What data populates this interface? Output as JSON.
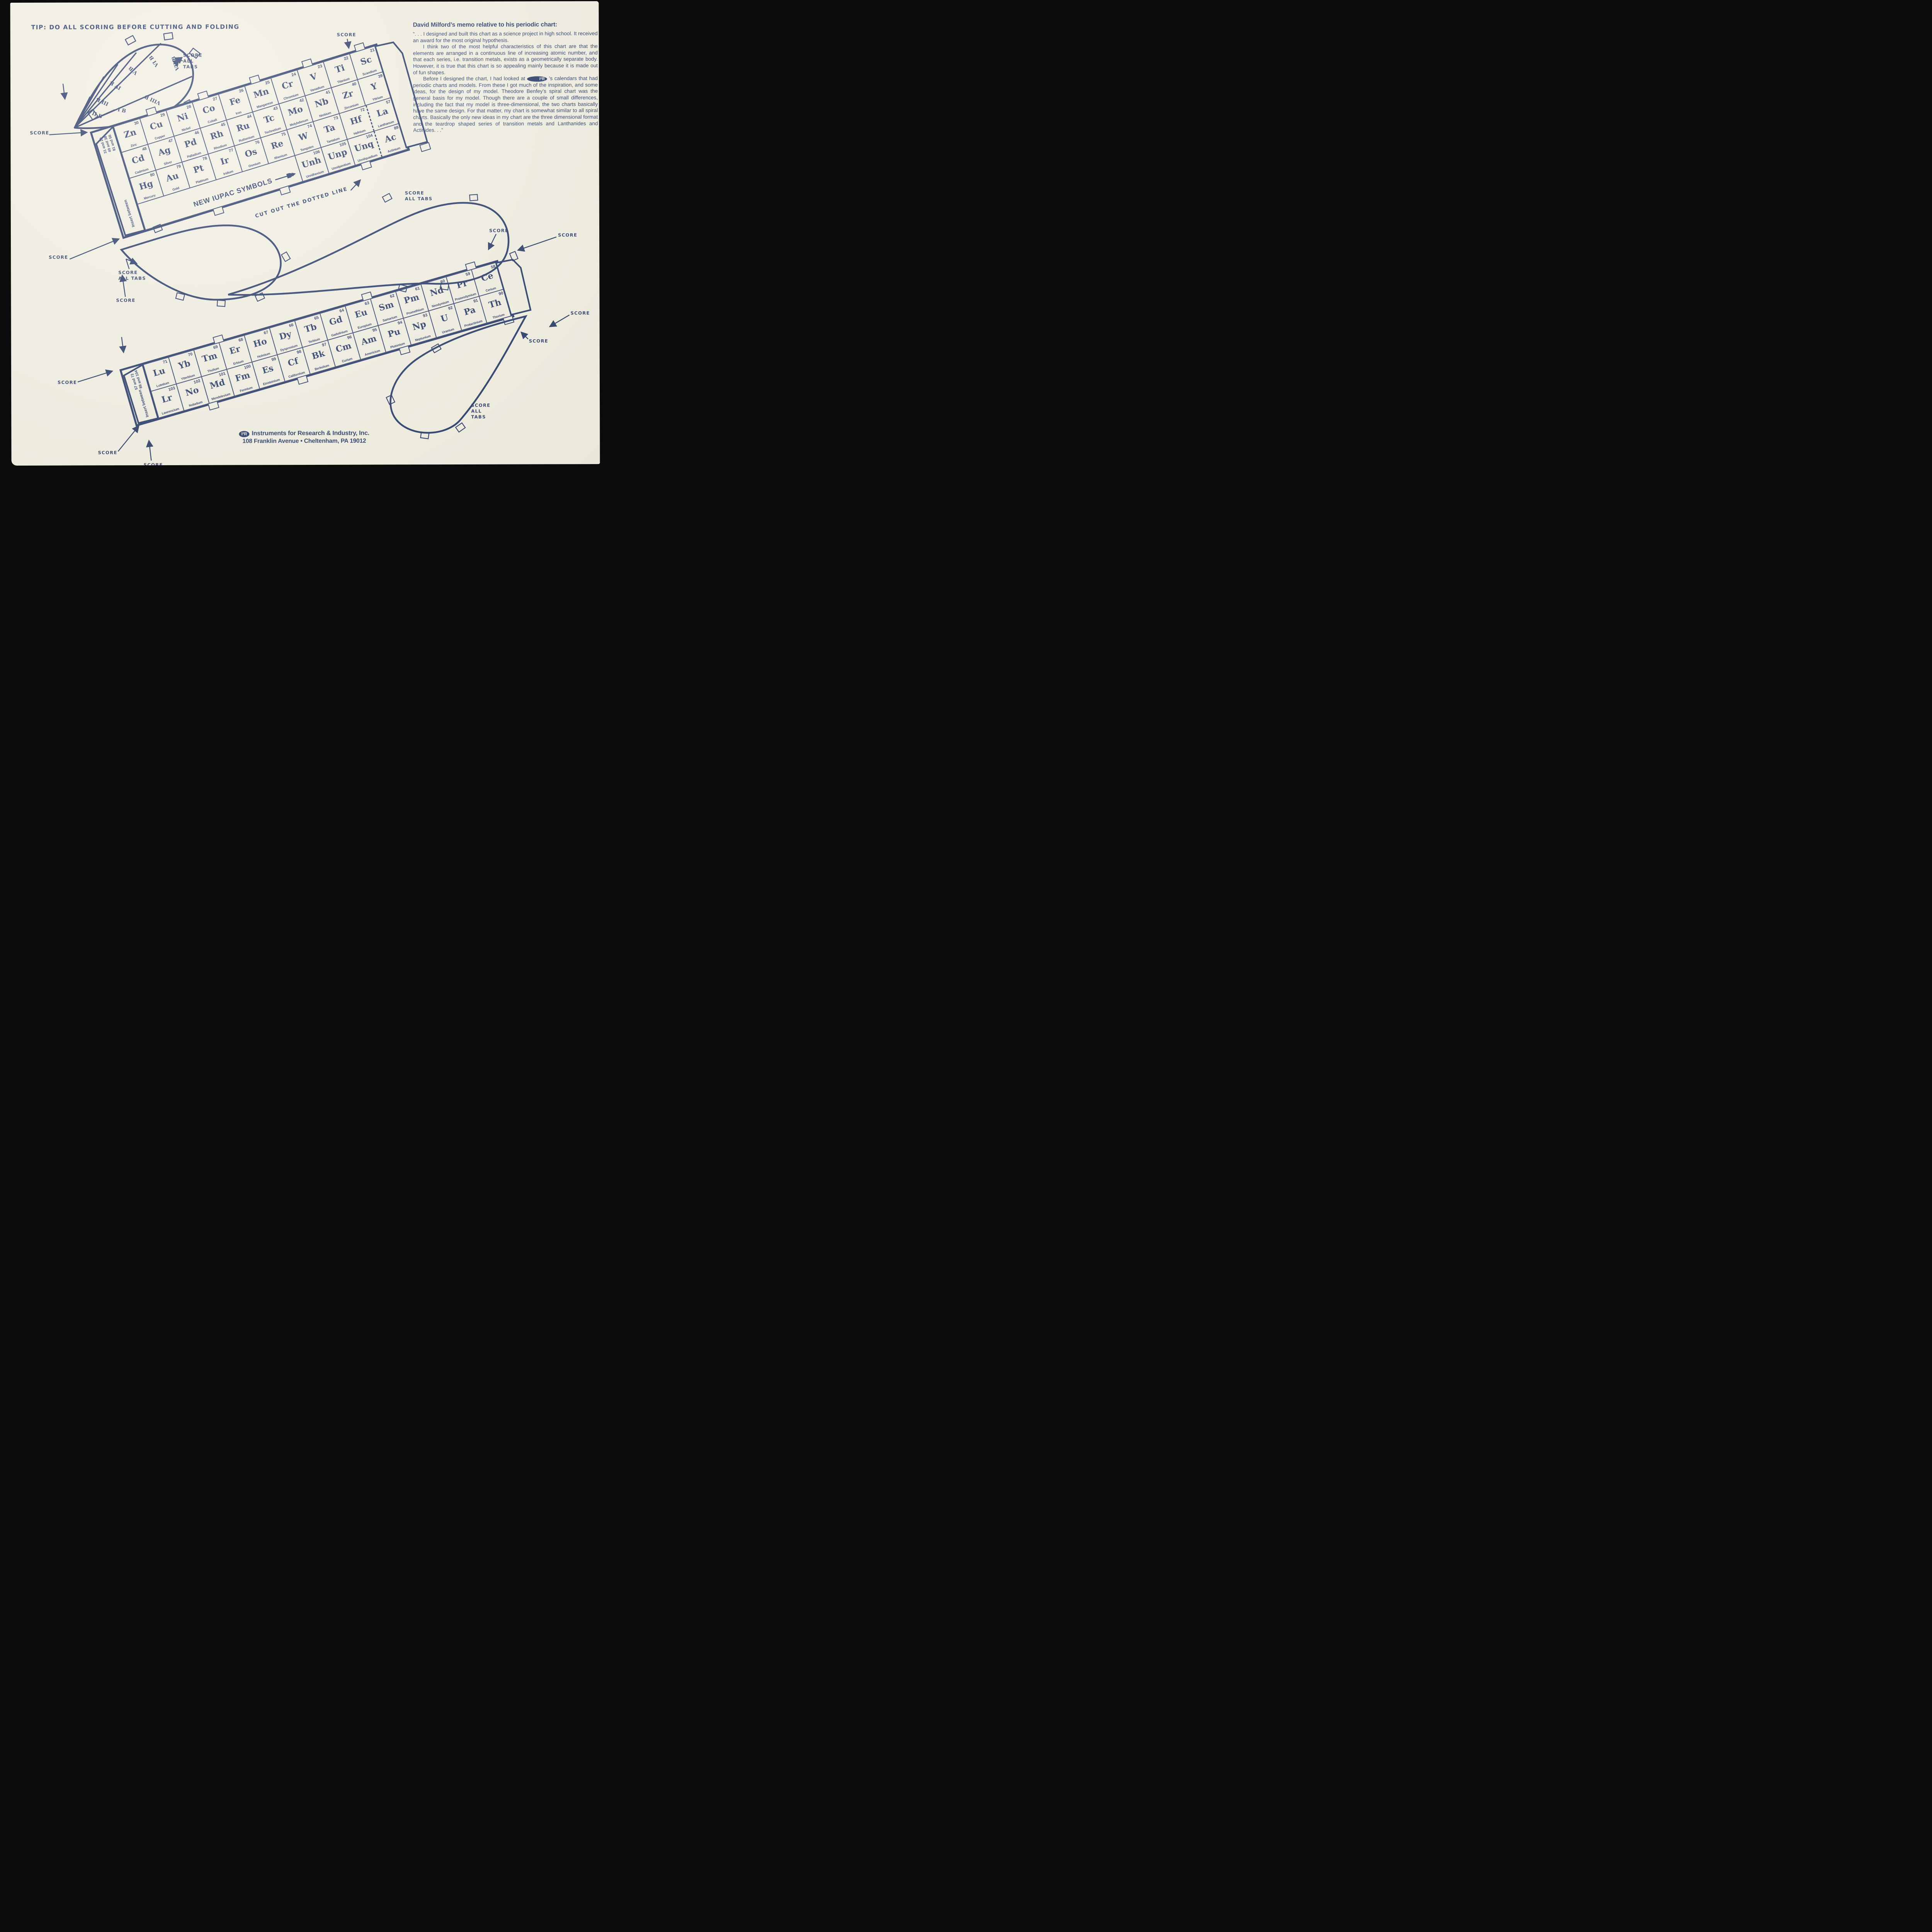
{
  "colors": {
    "ink": "#2e3f6b",
    "paper": "#f2efe2",
    "scan_bg": "#0b0b0b"
  },
  "tip_note": {
    "lines": [
      "TIP:  DO ALL SCORING",
      "BEFORE CUTTING",
      "AND FOLDING"
    ]
  },
  "memo": {
    "title": "David Milford’s memo relative to his periodic chart:",
    "p1": "“. . . I designed and built this chart as a science project in high school. It received an award for the most original hypothesis.",
    "p2": "I think two of the most helpful characteristics of this chart are that the elements are arranged in a continuous line of increasing atomic number, and that each series, i.e. transition metals, exists as a geometrically separate body. However, it is true that this chart is so appealing mainly because it is made out of fun shapes.",
    "p3_before": "Before I designed the chart, I had looked at ",
    "logo": "I²R",
    "p3_after": " ’s calendars that had periodic charts and models. From these I got much of the inspiration, and some ideas, for the design of my model. Theodore Benfey’s spiral chart was the general basis for my model. Though there are a couple of small differences, including the fact that my model is three-dimensional, the two charts basically have the same design. For that matter, my chart is somewhat similar to all spiral charts. Basically the only new ideas in my chart are the three dimensional format and the teardrop shaped series of transition metals and Lanthanides and Actinides. . .”"
  },
  "upper_strip": {
    "flap": {
      "label": "Insert between",
      "lines": [
        "31 and 20",
        "49 and 38",
        "81 and 56"
      ]
    },
    "rows": [
      [
        {
          "n": "30",
          "s": "Zn",
          "name": "Zinc"
        },
        {
          "n": "29",
          "s": "Cu",
          "name": "Copper"
        },
        {
          "n": "28",
          "s": "Ni",
          "name": "Nickel"
        },
        {
          "n": "27",
          "s": "Co",
          "name": "Cobalt"
        },
        {
          "n": "26",
          "s": "Fe",
          "name": "Iron"
        },
        {
          "n": "25",
          "s": "Mn",
          "name": "Manganese"
        },
        {
          "n": "24",
          "s": "Cr",
          "name": "Chromium"
        },
        {
          "n": "23",
          "s": "V",
          "name": "Vanadium"
        },
        {
          "n": "22",
          "s": "Ti",
          "name": "Titanium"
        },
        {
          "n": "21",
          "s": "Sc",
          "name": "Scandium"
        }
      ],
      [
        {
          "n": "48",
          "s": "Cd",
          "name": "Cadmium"
        },
        {
          "n": "47",
          "s": "Ag",
          "name": "Silver"
        },
        {
          "n": "46",
          "s": "Pd",
          "name": "Palladium"
        },
        {
          "n": "45",
          "s": "Rh",
          "name": "Rhodium"
        },
        {
          "n": "44",
          "s": "Ru",
          "name": "Ruthenium"
        },
        {
          "n": "43",
          "s": "Tc",
          "name": "Technetium"
        },
        {
          "n": "42",
          "s": "Mo",
          "name": "Molybdenum"
        },
        {
          "n": "41",
          "s": "Nb",
          "name": "Niobium"
        },
        {
          "n": "40",
          "s": "Zr",
          "name": "Zirconium"
        },
        {
          "n": "39",
          "s": "Y",
          "name": "Yttrium"
        }
      ],
      [
        {
          "n": "80",
          "s": "Hg",
          "name": "Mercury"
        },
        {
          "n": "79",
          "s": "Au",
          "name": "Gold"
        },
        {
          "n": "78",
          "s": "Pt",
          "name": "Platinum"
        },
        {
          "n": "77",
          "s": "Ir",
          "name": "Iridium"
        },
        {
          "n": "76",
          "s": "Os",
          "name": "Osmium"
        },
        {
          "n": "75",
          "s": "Re",
          "name": "Rhenium"
        },
        {
          "n": "74",
          "s": "W",
          "name": "Tungsten"
        },
        {
          "n": "73",
          "s": "Ta",
          "name": "Tantalum"
        },
        {
          "n": "72",
          "s": "Hf",
          "name": "Hafnium"
        },
        {
          "n": "57",
          "s": "La",
          "name": "Lanthanum"
        }
      ]
    ],
    "row4": [
      {
        "n": "106",
        "s": "Unh",
        "name": "Unnilhexium"
      },
      {
        "n": "105",
        "s": "Unp",
        "name": "Unnilpentium"
      },
      {
        "n": "104",
        "s": "Unq",
        "name": "Unnilquadium"
      },
      {
        "n": "89",
        "s": "Ac",
        "name": "Actinium"
      }
    ],
    "row4_note": "NEW IUPAC SYMBOLS"
  },
  "lower_strip": {
    "flap": {
      "label": "Insert between",
      "lines": [
        "57 and 72",
        "89 and 104"
      ]
    },
    "rows": [
      [
        {
          "n": "71",
          "s": "Lu",
          "name": "Lutetium"
        },
        {
          "n": "70",
          "s": "Yb",
          "name": "Ytterbium"
        },
        {
          "n": "69",
          "s": "Tm",
          "name": "Thulium"
        },
        {
          "n": "68",
          "s": "Er",
          "name": "Erbium"
        },
        {
          "n": "67",
          "s": "Ho",
          "name": "Holmium"
        },
        {
          "n": "66",
          "s": "Dy",
          "name": "Dysprosium"
        },
        {
          "n": "65",
          "s": "Tb",
          "name": "Terbium"
        },
        {
          "n": "64",
          "s": "Gd",
          "name": "Gadolinium"
        },
        {
          "n": "63",
          "s": "Eu",
          "name": "Europium"
        },
        {
          "n": "62",
          "s": "Sm",
          "name": "Samarium"
        },
        {
          "n": "61",
          "s": "Pm",
          "name": "Promethium"
        },
        {
          "n": "60",
          "s": "Nd",
          "name": "Neodymium"
        },
        {
          "n": "59",
          "s": "Pr",
          "name": "Praseodymium"
        },
        {
          "n": "58",
          "s": "Ce",
          "name": "Cerium"
        }
      ],
      [
        {
          "n": "103",
          "s": "Lr",
          "name": "Lawrencium"
        },
        {
          "n": "102",
          "s": "No",
          "name": "Nobelium"
        },
        {
          "n": "101",
          "s": "Md",
          "name": "Mendelevium"
        },
        {
          "n": "100",
          "s": "Fm",
          "name": "Fermium"
        },
        {
          "n": "99",
          "s": "Es",
          "name": "Einsteinium"
        },
        {
          "n": "98",
          "s": "Cf",
          "name": "Californium"
        },
        {
          "n": "97",
          "s": "Bk",
          "name": "Berkelium"
        },
        {
          "n": "96",
          "s": "Cm",
          "name": "Curium"
        },
        {
          "n": "95",
          "s": "Am",
          "name": "Americium"
        },
        {
          "n": "94",
          "s": "Pu",
          "name": "Plutonium"
        },
        {
          "n": "93",
          "s": "Np",
          "name": "Neptunium"
        },
        {
          "n": "92",
          "s": "U",
          "name": "Uranium"
        },
        {
          "n": "91",
          "s": "Pa",
          "name": "Protactinium"
        },
        {
          "n": "90",
          "s": "Th",
          "name": "Thorium"
        }
      ]
    ]
  },
  "teardrop_groups": [
    "II B",
    "I B",
    "III B",
    "IV B",
    "V B",
    "VI B",
    "VII B",
    "VIII B"
  ],
  "annotations": [
    {
      "id": "score-left-top",
      "text": "SCORE"
    },
    {
      "id": "score-left-mid",
      "text": "SCORE"
    },
    {
      "id": "score-all-tabs-mid",
      "text": "SCORE\nALL TABS"
    },
    {
      "id": "score-mid",
      "text": "SCORE"
    },
    {
      "id": "score-top",
      "text": "SCORE"
    },
    {
      "id": "score-all-tabs-top",
      "text": "SCORE\nALL\nTABS"
    },
    {
      "id": "cut-note",
      "text": "CUT OUT THE DOTTED LINE"
    },
    {
      "id": "score-r1",
      "text": "SCORE"
    },
    {
      "id": "score-r2",
      "text": "SCORE"
    },
    {
      "id": "score-r3",
      "text": "SCORE"
    },
    {
      "id": "score-r4",
      "text": "SCORE"
    },
    {
      "id": "score-all-tabs-right",
      "text": "SCORE\nALL TABS"
    },
    {
      "id": "score-all-tabs-bottom",
      "text": "SCORE\nALL\nTABS"
    },
    {
      "id": "score-bl1",
      "text": "SCORE"
    },
    {
      "id": "score-bl2",
      "text": "SCORE"
    },
    {
      "id": "score-bl3",
      "text": "SCORE"
    }
  ],
  "footer": {
    "logo": "I²R",
    "line1": "Instruments for Research & Industry, Inc.",
    "line2": "108 Franklin Avenue • Cheltenham, PA 19012"
  }
}
